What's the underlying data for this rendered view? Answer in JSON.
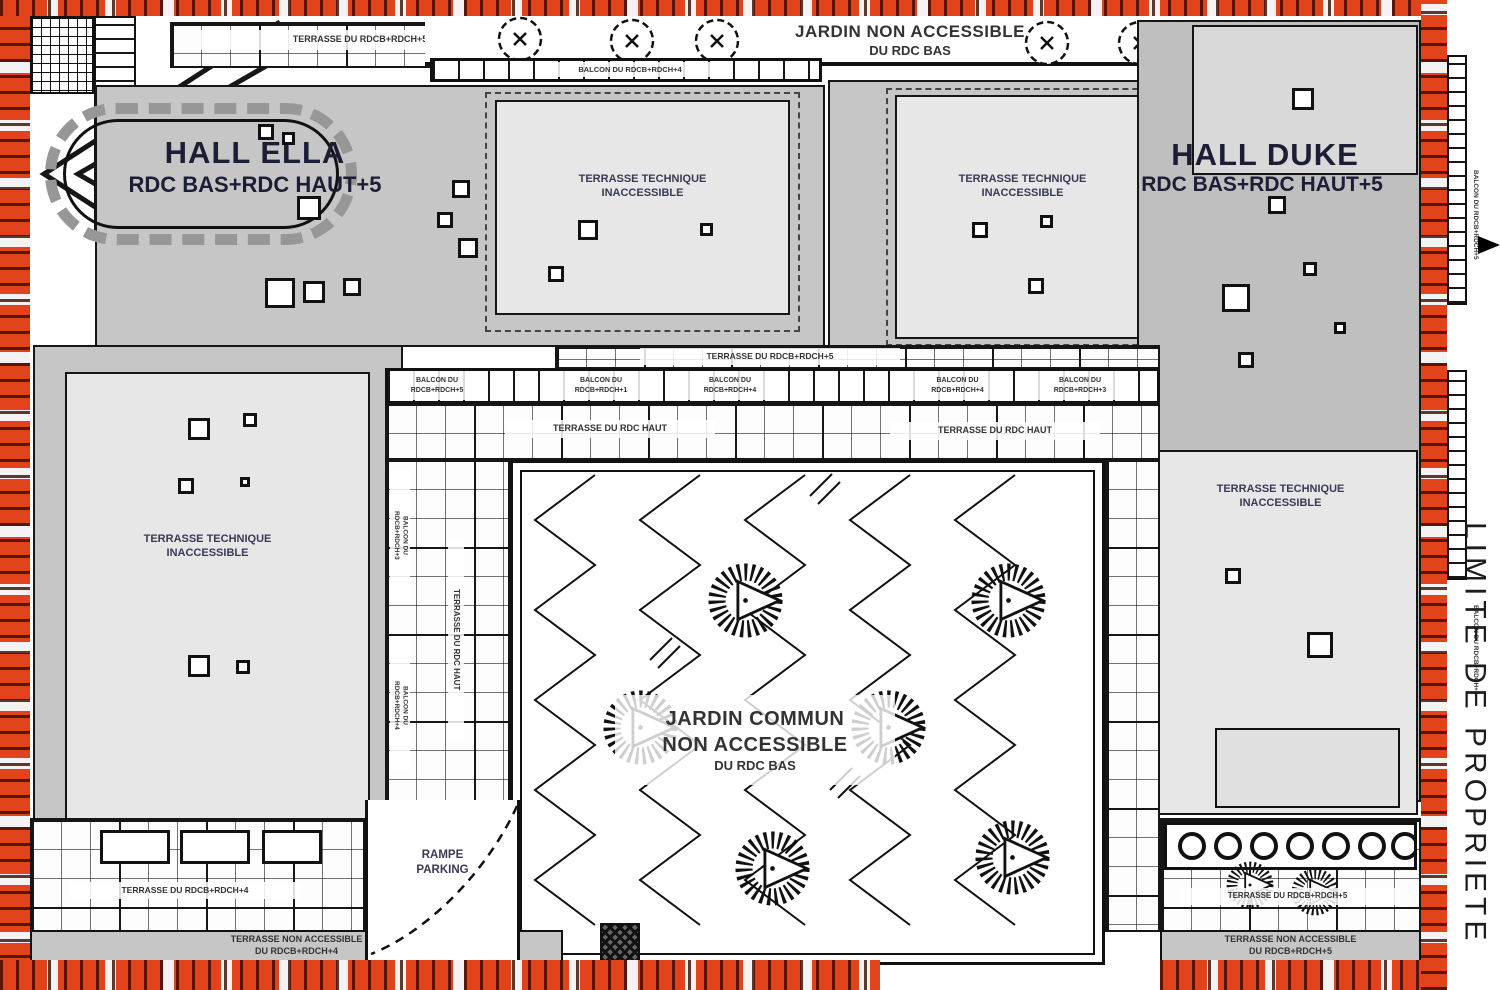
{
  "colors": {
    "limit_red": "#e2431b",
    "roof_gray": "#c6c6c6",
    "panel_gray": "#e7e7e7",
    "line_black": "#161616"
  },
  "property_limit_label": "LIMITE DE PROPRIETE",
  "hall_ella": {
    "name": "HALL ELLA",
    "levels": "RDC BAS+RDC HAUT+5"
  },
  "hall_duke": {
    "name": "HALL DUKE",
    "levels": "RDC BAS+RDC HAUT+5"
  },
  "jardin_nord": {
    "line1": "JARDIN NON ACCESSIBLE",
    "line2": "DU RDC BAS"
  },
  "jardin_commun": {
    "line1": "JARDIN COMMUN",
    "line2": "NON ACCESSIBLE",
    "line3": "DU RDC BAS"
  },
  "terrasse_technique": {
    "line1": "TERRASSE TECHNIQUE",
    "line2": "INACCESSIBLE"
  },
  "rampe_parking": {
    "line1": "RAMPE",
    "line2": "PARKING"
  },
  "labels": {
    "terrasse_du_rdcb_rdch5": "TERRASSE DU RDCB+RDCH+5",
    "terrasse_du_rdcb_rdch4": "TERRASSE DU RDCB+RDCH+4",
    "terrasse_du_rdc_haut": "TERRASSE DU RDC HAUT",
    "balcon_du": "BALCON DU",
    "balcon_du_rdcb_rdch4": "BALCON DU RDCB+RDCH+4",
    "balcon_du_rdcb_rdch5": "BALCON DU RDCB+RDCH+5",
    "terrasse_non_accessible": "TERRASSE NON ACCESSIBLE",
    "du_rdcb_rdch4": "DU RDCB+RDCH+4",
    "du_rdcb_rdch5": "DU RDCB+RDCH+5"
  },
  "mid_balcony_chips": [
    {
      "top": "BALCON DU",
      "bottom": "RDCB+RDCH+5"
    },
    {
      "top": "BALCON DU",
      "bottom": "RDCB+RDCH+1"
    },
    {
      "top": "BALCON DU",
      "bottom": "RDCB+RDCH+4"
    },
    {
      "top": "BALCON DU",
      "bottom": "RDCB+RDCH+4"
    },
    {
      "top": "BALCON DU",
      "bottom": "RDCB+RDCH+3"
    }
  ],
  "side_balcony_chips": [
    {
      "top": "BALCON DU",
      "bottom": "RDCB+RDCH+3"
    },
    {
      "top": "BALCON DU",
      "bottom": "RDCB+RDCH+4"
    }
  ]
}
